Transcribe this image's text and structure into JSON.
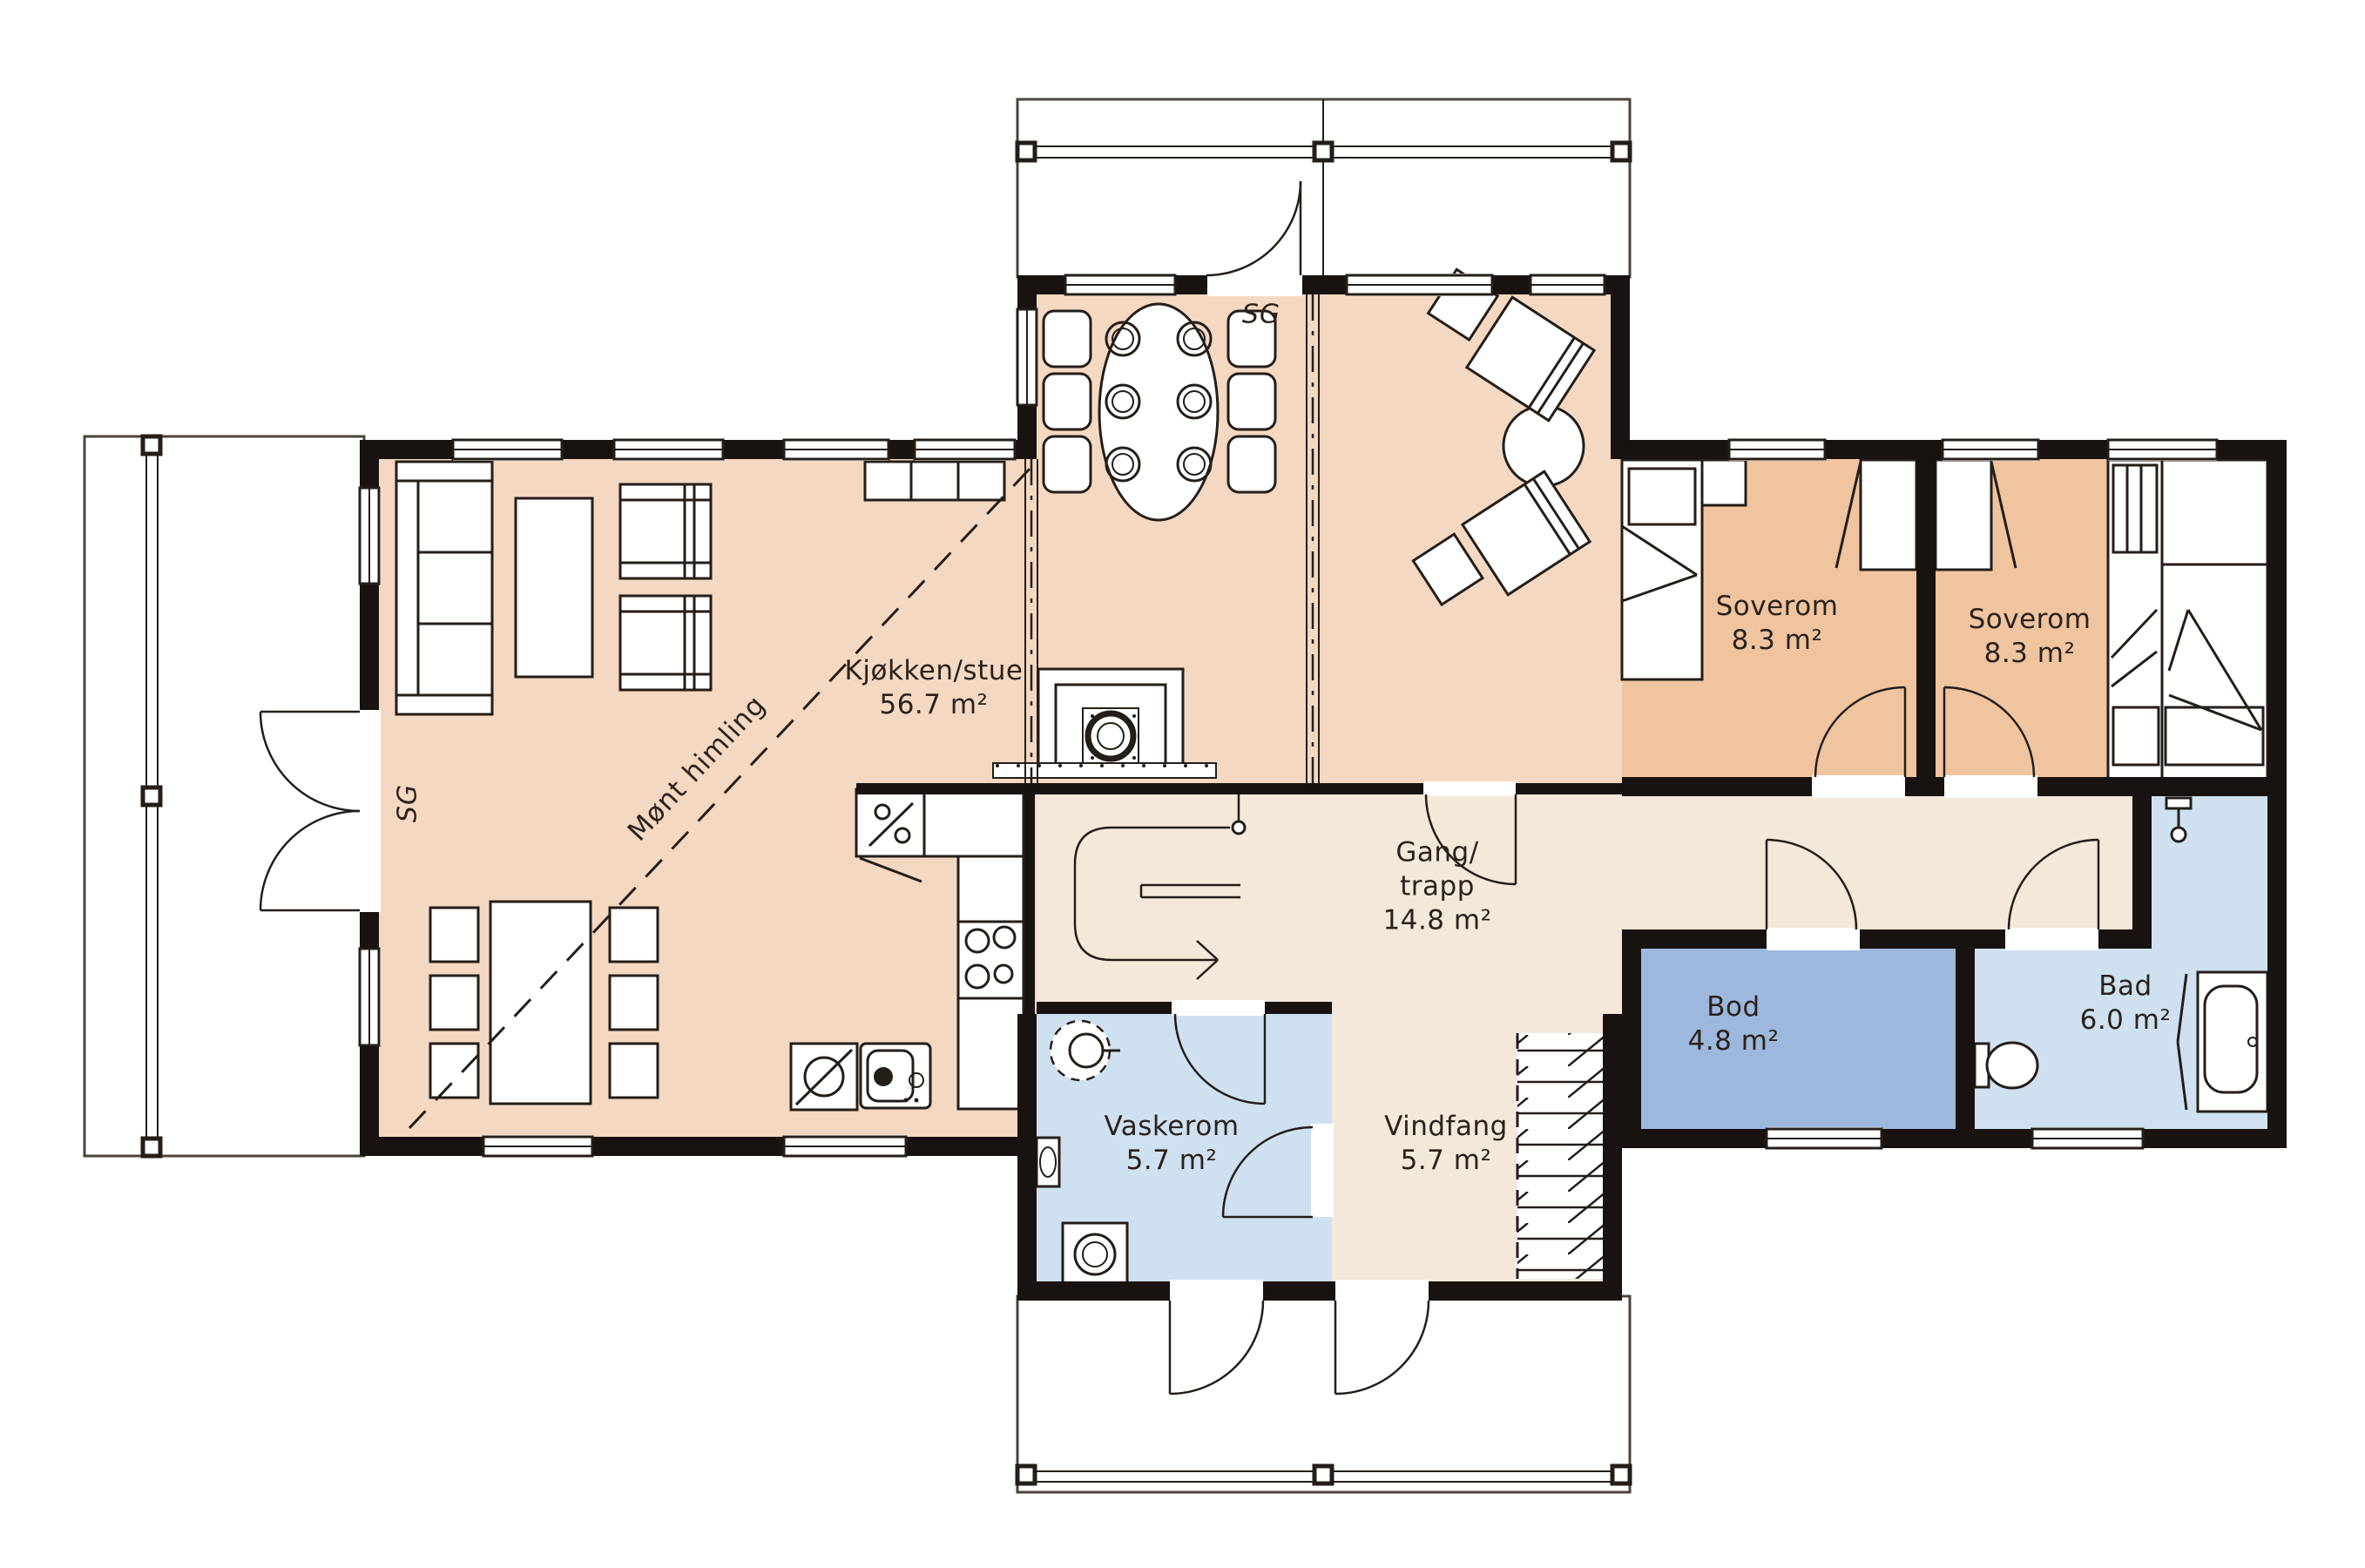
{
  "plan": {
    "rooms": [
      {
        "id": "kjokken-stue",
        "lines": [
          "Kjøkken/stue",
          "56.7 m²"
        ]
      },
      {
        "id": "gang-trapp",
        "lines": [
          "Gang/",
          "trapp",
          "14.8 m²"
        ]
      },
      {
        "id": "soverom-1",
        "lines": [
          "Soverom",
          "8.3 m²"
        ]
      },
      {
        "id": "soverom-2",
        "lines": [
          "Soverom",
          "8.3 m²"
        ]
      },
      {
        "id": "bod",
        "lines": [
          "Bod",
          "4.8 m²"
        ]
      },
      {
        "id": "bad",
        "lines": [
          "Bad",
          "6.0 m²"
        ]
      },
      {
        "id": "vaskerom",
        "lines": [
          "Vaskerom",
          "5.7 m²"
        ]
      },
      {
        "id": "vindfang",
        "lines": [
          "Vindfang",
          "5.7 m²"
        ]
      }
    ],
    "annotations": {
      "sg_top": "SG",
      "sg_left": "SG",
      "ceiling_note": "Mønt himling"
    },
    "colors": {
      "living": "#f5d8c2",
      "bedroom": "#efc49f",
      "corridor": "#f4e8da",
      "storage": "#9cb8dc",
      "wet": "#cfe1f0",
      "wall": "#181310"
    }
  }
}
